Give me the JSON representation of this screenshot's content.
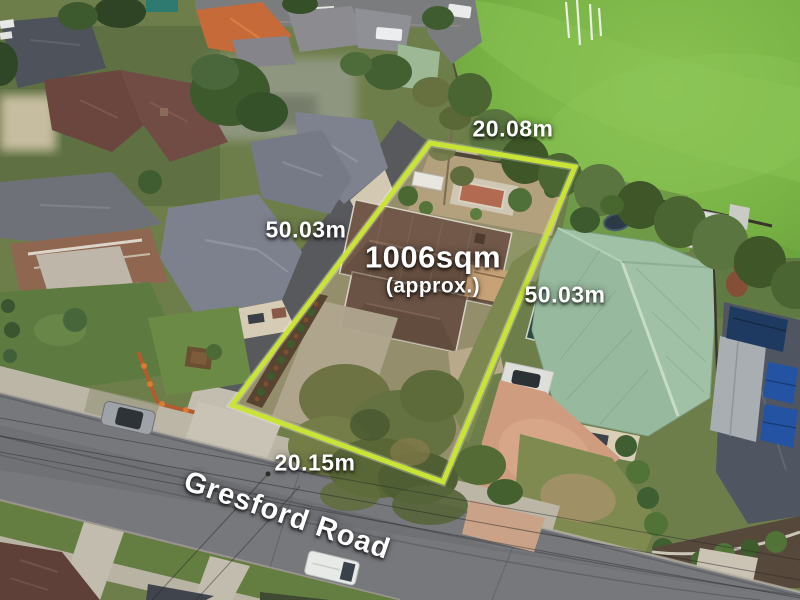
{
  "photo": {
    "type": "aerial-property-photo",
    "subject": "outlined residential allotment"
  },
  "annotations": {
    "dimensions": {
      "top": "20.08m",
      "left": "50.03m",
      "right": "50.03m",
      "bottom": "20.15m"
    },
    "area_label": {
      "value": "1006sqm",
      "qualifier": "(approx.)"
    },
    "street_name": "Gresford Road",
    "boundary_color": "#c9e437",
    "label_color": "#ffffff"
  }
}
